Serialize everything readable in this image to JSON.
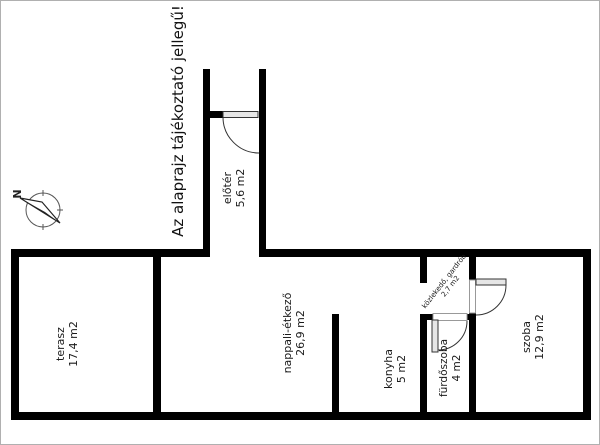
{
  "note": {
    "text": "Az alaprajz tájékoztató jellegű!"
  },
  "compass": {
    "label": "N"
  },
  "rooms": [
    {
      "id": "terasz",
      "name": "terasz",
      "area": "17,4 m2"
    },
    {
      "id": "nappali",
      "name": "nappali-étkező",
      "area": "26,9 m2"
    },
    {
      "id": "konyha",
      "name": "konyha",
      "area": "5 m2"
    },
    {
      "id": "furdoszoba",
      "name": "fürdőszoba",
      "area": "4  m2"
    },
    {
      "id": "szoba",
      "name": "szoba",
      "area": "12,9 m2"
    },
    {
      "id": "eloter",
      "name": "előtér",
      "area": "5,6 m2"
    },
    {
      "id": "kozlekedo",
      "name": "közlekedő, gardrób",
      "area": "2,7 m2"
    }
  ],
  "colors": {
    "wall": "#000000",
    "door_line": "#333333",
    "door_leaf_fill": "#e6e6e6",
    "threshold_border": "#999999",
    "text": "#1a1a1a",
    "background": "#ffffff"
  }
}
